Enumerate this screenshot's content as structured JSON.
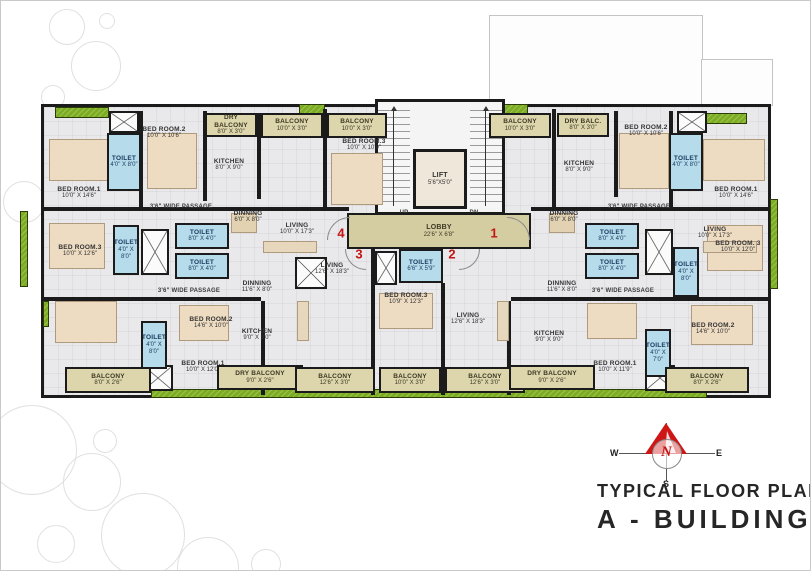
{
  "title": {
    "plan_type": "TYPICAL FLOOR PLAN",
    "building": "A - BUILDING"
  },
  "compass": {
    "north": "N",
    "south": "S",
    "east": "E",
    "west": "W"
  },
  "colors": {
    "accent_red": "#c41414",
    "balcony_fill": "#ddd5ac",
    "toilet_fill": "#b6dbeb",
    "lobby_fill": "#d5cda2",
    "lawn_green": "#7cac1f",
    "wall": "#1b1b1b"
  },
  "plan": {
    "flat_numbers": [
      {
        "value": "4",
        "x": 340,
        "y": 232
      },
      {
        "value": "1",
        "x": 493,
        "y": 232
      },
      {
        "value": "3",
        "x": 358,
        "y": 253
      },
      {
        "value": "2",
        "x": 451,
        "y": 253
      }
    ],
    "rooms": [
      {
        "name": "BED ROOM.1",
        "dims": "10'0\" X 14'6\"",
        "type": "room",
        "x": 40,
        "y": 182,
        "w": 76,
        "h": 20
      },
      {
        "name": "TOILET",
        "dims": "4'0\" X 8'0\"",
        "type": "toilet",
        "x": 106,
        "y": 132,
        "w": 34,
        "h": 58
      },
      {
        "name": "BED ROOM.2",
        "dims": "10'0\" X 10'6\"",
        "type": "room",
        "x": 125,
        "y": 122,
        "w": 76,
        "h": 20
      },
      {
        "name": "DRY BALCONY",
        "dims": "8'0\" X 3'0\"",
        "type": "balcony",
        "x": 204,
        "y": 112,
        "w": 52,
        "h": 24
      },
      {
        "name": "KITCHEN",
        "dims": "8'0\" X 9'0\"",
        "type": "room",
        "x": 198,
        "y": 154,
        "w": 60,
        "h": 20
      },
      {
        "name": "BALCONY",
        "dims": "10'0\" X 3'0\"",
        "type": "balcony",
        "x": 260,
        "y": 112,
        "w": 62,
        "h": 25
      },
      {
        "name": "BALCONY",
        "dims": "10'0\" X 3'0\"",
        "type": "balcony",
        "x": 326,
        "y": 112,
        "w": 60,
        "h": 25
      },
      {
        "name": "BED ROOM.3",
        "dims": "10'0\" X 10'9\"",
        "type": "room",
        "x": 325,
        "y": 134,
        "w": 76,
        "h": 20
      },
      {
        "name": "3'6\" WIDE PASSAGE",
        "dims": "",
        "type": "passage",
        "x": 132,
        "y": 200,
        "w": 96,
        "h": 12
      },
      {
        "name": "DINNING",
        "dims": "6'0\" X 8'0\"",
        "type": "room",
        "x": 222,
        "y": 206,
        "w": 50,
        "h": 20
      },
      {
        "name": "LIVING",
        "dims": "10'0\" X 17'3\"",
        "type": "room",
        "x": 258,
        "y": 218,
        "w": 76,
        "h": 20
      },
      {
        "name": "BALCONY",
        "dims": "10'0\" X 3'0\"",
        "type": "balcony",
        "x": 488,
        "y": 112,
        "w": 62,
        "h": 25
      },
      {
        "name": "DRY BALC.",
        "dims": "8'0\" X 3'0\"",
        "type": "balcony",
        "x": 556,
        "y": 112,
        "w": 52,
        "h": 24
      },
      {
        "name": "BED ROOM.2",
        "dims": "10'0\" X 10'6\"",
        "type": "room",
        "x": 607,
        "y": 120,
        "w": 76,
        "h": 20
      },
      {
        "name": "KITCHEN",
        "dims": "8'0\" X 9'0\"",
        "type": "room",
        "x": 548,
        "y": 156,
        "w": 60,
        "h": 20
      },
      {
        "name": "TOILET",
        "dims": "4'0\" X 8'0\"",
        "type": "toilet",
        "x": 668,
        "y": 132,
        "w": 34,
        "h": 58
      },
      {
        "name": "BED ROOM.1",
        "dims": "10'0\" X 14'6\"",
        "type": "room",
        "x": 697,
        "y": 182,
        "w": 76,
        "h": 20
      },
      {
        "name": "3'6\" WIDE PASSAGE",
        "dims": "",
        "type": "passage",
        "x": 590,
        "y": 200,
        "w": 96,
        "h": 12
      },
      {
        "name": "DINNING",
        "dims": "6'0\" X 8'0\"",
        "type": "room",
        "x": 538,
        "y": 206,
        "w": 50,
        "h": 20
      },
      {
        "name": "LIVING",
        "dims": "10'0\" X 17'3\"",
        "type": "room",
        "x": 676,
        "y": 222,
        "w": 76,
        "h": 20
      },
      {
        "name": "LIFT",
        "dims": "5'6\"X5'0\"",
        "type": "lift",
        "x": 412,
        "y": 148,
        "w": 54,
        "h": 60
      },
      {
        "name": "UP",
        "dims": "",
        "type": "passage",
        "x": 392,
        "y": 207,
        "w": 22,
        "h": 11
      },
      {
        "name": "DN",
        "dims": "",
        "type": "passage",
        "x": 462,
        "y": 207,
        "w": 22,
        "h": 11
      },
      {
        "name": "LOBBY",
        "dims": "22'6\" X 6'8\"",
        "type": "lobby",
        "x": 346,
        "y": 212,
        "w": 184,
        "h": 36
      },
      {
        "name": "TOILET",
        "dims": "6'6\" X 5'9\"",
        "type": "toilet",
        "x": 398,
        "y": 248,
        "w": 44,
        "h": 34
      },
      {
        "name": "BED ROOM.3",
        "dims": "10'0\" X 12'6\"",
        "type": "room",
        "x": 42,
        "y": 240,
        "w": 74,
        "h": 20
      },
      {
        "name": "TOILET",
        "dims": "4'0\" X 8'0\"",
        "type": "toilet",
        "x": 112,
        "y": 224,
        "w": 26,
        "h": 50
      },
      {
        "name": "TOILET",
        "dims": "8'0\" X 4'0\"",
        "type": "toilet",
        "x": 174,
        "y": 222,
        "w": 54,
        "h": 26
      },
      {
        "name": "TOILET",
        "dims": "8'0\" X 4'0\"",
        "type": "toilet",
        "x": 174,
        "y": 252,
        "w": 54,
        "h": 26
      },
      {
        "name": "DINNING",
        "dims": "11'6\" X 8'0\"",
        "type": "room",
        "x": 228,
        "y": 276,
        "w": 56,
        "h": 20
      },
      {
        "name": "3'6\" WIDE PASSAGE",
        "dims": "",
        "type": "passage",
        "x": 140,
        "y": 284,
        "w": 96,
        "h": 12
      },
      {
        "name": "BED ROOM.2",
        "dims": "14'6\" X 10'0\"",
        "type": "room",
        "x": 172,
        "y": 312,
        "w": 76,
        "h": 20
      },
      {
        "name": "TOILET",
        "dims": "4'0\" X 8'0\"",
        "type": "toilet",
        "x": 140,
        "y": 320,
        "w": 26,
        "h": 48
      },
      {
        "name": "BED ROOM.1",
        "dims": "10'0\" X 12'0\"",
        "type": "room",
        "x": 166,
        "y": 356,
        "w": 72,
        "h": 20
      },
      {
        "name": "KITCHEN",
        "dims": "9'0\" X 9'0\"",
        "type": "room",
        "x": 228,
        "y": 324,
        "w": 56,
        "h": 20
      },
      {
        "name": "LIVING",
        "dims": "12'6\" X 18'3\"",
        "type": "room",
        "x": 294,
        "y": 258,
        "w": 74,
        "h": 20
      },
      {
        "name": "BALCONY",
        "dims": "8'0\" X 2'6\"",
        "type": "balcony",
        "x": 64,
        "y": 366,
        "w": 86,
        "h": 26
      },
      {
        "name": "DRY BALCONY",
        "dims": "9'0\" X 2'6\"",
        "type": "balcony",
        "x": 216,
        "y": 364,
        "w": 86,
        "h": 25
      },
      {
        "name": "BALCONY",
        "dims": "12'6\" X 3'0\"",
        "type": "balcony",
        "x": 294,
        "y": 366,
        "w": 80,
        "h": 26
      },
      {
        "name": "BED ROOM.3",
        "dims": "10'9\" X 12'3\"",
        "type": "room",
        "x": 368,
        "y": 288,
        "w": 74,
        "h": 20
      },
      {
        "name": "BALCONY",
        "dims": "10'0\" X 3'0\"",
        "type": "balcony",
        "x": 378,
        "y": 366,
        "w": 62,
        "h": 26
      },
      {
        "name": "LIVING",
        "dims": "12'6\" X 18'3\"",
        "type": "room",
        "x": 430,
        "y": 308,
        "w": 74,
        "h": 20
      },
      {
        "name": "BALCONY",
        "dims": "12'6\" X 3'0\"",
        "type": "balcony",
        "x": 444,
        "y": 366,
        "w": 80,
        "h": 26
      },
      {
        "name": "DINNING",
        "dims": "11'6\" X 8'0\"",
        "type": "room",
        "x": 532,
        "y": 276,
        "w": 58,
        "h": 20
      },
      {
        "name": "3'6\" WIDE PASSAGE",
        "dims": "",
        "type": "passage",
        "x": 574,
        "y": 284,
        "w": 96,
        "h": 12
      },
      {
        "name": "TOILET",
        "dims": "8'0\" X 4'0\"",
        "type": "toilet",
        "x": 584,
        "y": 222,
        "w": 54,
        "h": 26
      },
      {
        "name": "TOILET",
        "dims": "8'0\" X 4'0\"",
        "type": "toilet",
        "x": 584,
        "y": 252,
        "w": 54,
        "h": 26
      },
      {
        "name": "TOILET",
        "dims": "4'0\" X 8'0\"",
        "type": "toilet",
        "x": 672,
        "y": 246,
        "w": 26,
        "h": 50
      },
      {
        "name": "BED ROOM. 3",
        "dims": "10'0\" X 12'0\"",
        "type": "room",
        "x": 700,
        "y": 236,
        "w": 74,
        "h": 20
      },
      {
        "name": "KITCHEN",
        "dims": "9'0\" X 9'0\"",
        "type": "room",
        "x": 520,
        "y": 326,
        "w": 56,
        "h": 20
      },
      {
        "name": "BED ROOM.1",
        "dims": "10'0\" X 11'9\"",
        "type": "room",
        "x": 578,
        "y": 356,
        "w": 72,
        "h": 20
      },
      {
        "name": "TOILET",
        "dims": "4'0\" X 7'0\"",
        "type": "toilet",
        "x": 644,
        "y": 328,
        "w": 26,
        "h": 48
      },
      {
        "name": "BED ROOM.2",
        "dims": "14'6\" X 10'0\"",
        "type": "room",
        "x": 674,
        "y": 318,
        "w": 76,
        "h": 20
      },
      {
        "name": "DRY BALCONY",
        "dims": "9'0\" X 2'6\"",
        "type": "balcony",
        "x": 508,
        "y": 364,
        "w": 86,
        "h": 25
      },
      {
        "name": "BALCONY",
        "dims": "8'0\" X 2'6\"",
        "type": "balcony",
        "x": 664,
        "y": 366,
        "w": 84,
        "h": 26
      }
    ]
  }
}
